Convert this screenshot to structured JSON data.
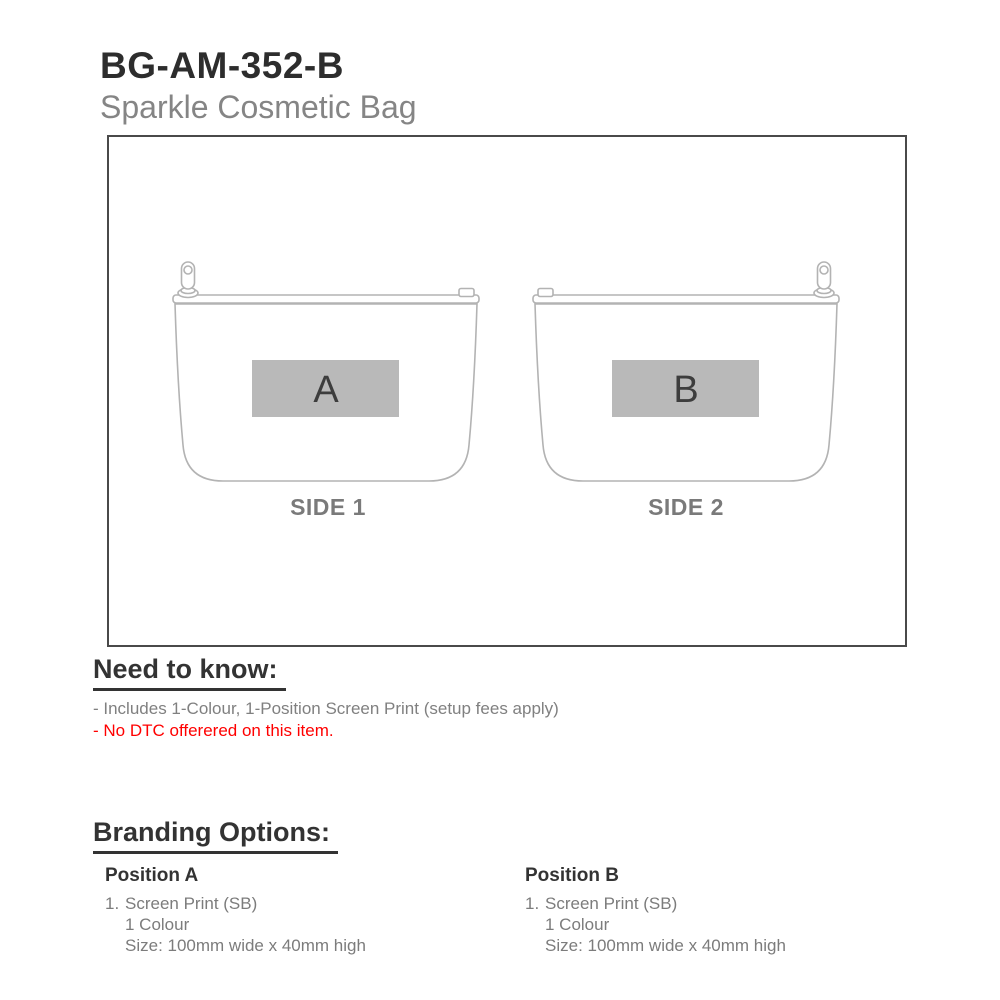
{
  "header": {
    "product_code": "BG-AM-352-B",
    "product_name": "Sparkle Cosmetic Bag"
  },
  "diagram": {
    "sides": [
      {
        "label": "SIDE 1",
        "position_letter": "A"
      },
      {
        "label": "SIDE 2",
        "position_letter": "B"
      }
    ]
  },
  "need_to_know": {
    "heading": "Need to know:",
    "note_1": "- Includes 1-Colour, 1-Position Screen Print (setup fees apply)",
    "note_2": "- No DTC offerered on this item."
  },
  "branding_options": {
    "heading": "Branding Options:",
    "positions": [
      {
        "title": "Position A",
        "item_number": "1.",
        "method": "Screen Print (SB)",
        "colour": "1 Colour",
        "size": "Size: 100mm wide x 40mm high"
      },
      {
        "title": "Position B",
        "item_number": "1.",
        "method": "Screen Print (SB)",
        "colour": "1 Colour",
        "size": "Size: 100mm wide x 40mm high"
      }
    ]
  },
  "colors": {
    "heading_text": "#333333",
    "body_text": "#808080",
    "warning_text": "#ff0000",
    "bag_outline": "#b3b3b3",
    "print_area_fill": "#b9b9b9",
    "print_letter": "#3d3d3d",
    "side_label": "#7a7a7a",
    "frame_border": "#4a4a4a"
  }
}
